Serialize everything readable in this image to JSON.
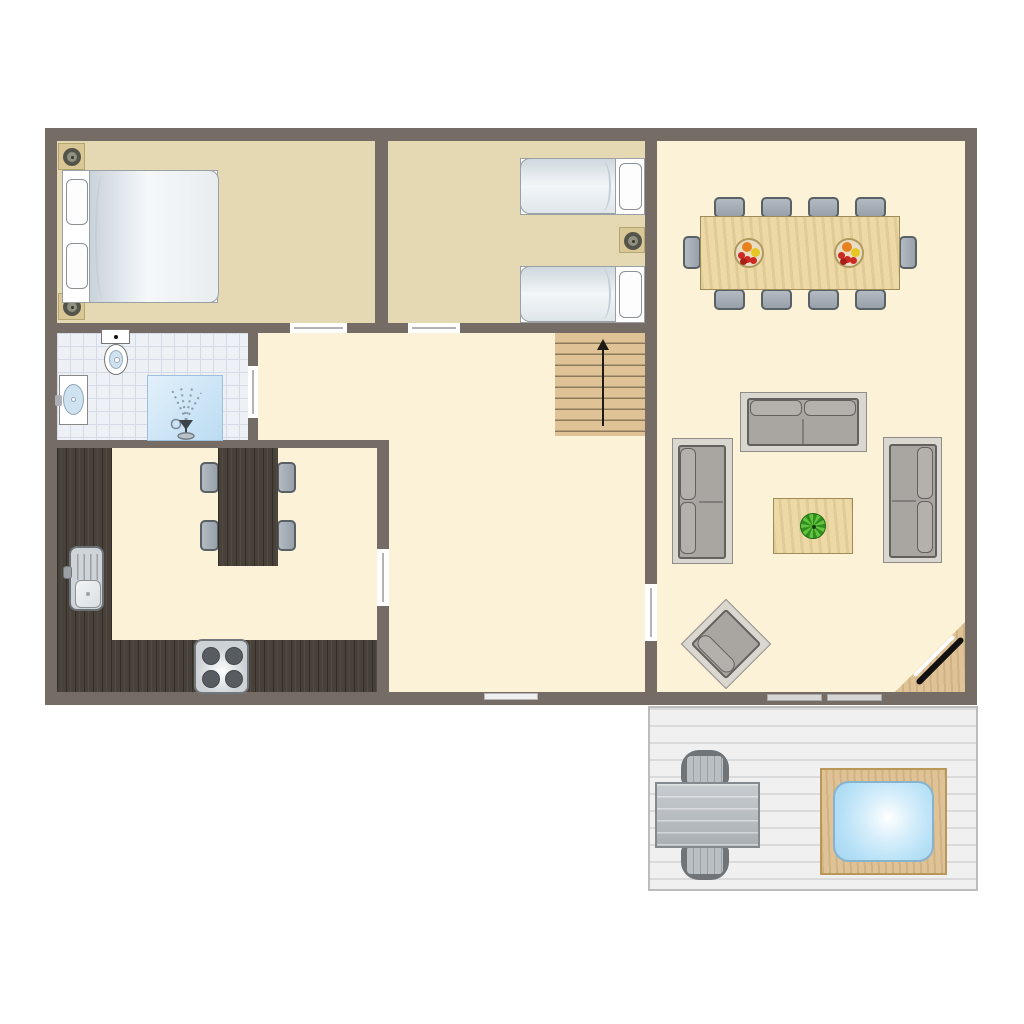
{
  "title": "Holiday home ground floor plan",
  "colors": {
    "wall": "#746c65",
    "floor-cream": "#fbf2d7",
    "floor-tan": "#e4d9b2",
    "tile": "#edf0f5",
    "tile-line": "#d5dbe6",
    "wood-light": "#ecd9a6",
    "wood-mid": "#dfc295",
    "wood-dark": "#474139",
    "deck": "#f0f0f0",
    "deck-line": "#dadada",
    "water": "#b5e0f6",
    "chair-border": "#596066",
    "sofa": "#a9a6a2",
    "sofa-base": "#dad7d1",
    "sofa-border": "#63605d",
    "bed-light": "#f5f8fa",
    "bed-shade": "#c9d3da",
    "fixture-border": "#8b9196",
    "basin-blue": "#cfe2f0",
    "door-line": "#b3b3b3",
    "plant-dark": "#2f8f1f",
    "plant-light": "#64c23c",
    "bowl": "#e9ddc3",
    "fruit-red": "#cc2a22",
    "fruit-orange": "#e8821e",
    "fruit-yellow": "#e8c622",
    "spot-square": "#d9c795",
    "arrow": "#1e1a14"
  },
  "plan": {
    "rooms": [
      {
        "name": "bedroom-double",
        "furniture": [
          "double-bed",
          "two-pillows",
          "spotlight",
          "spotlight"
        ],
        "door_to": "hallway"
      },
      {
        "name": "bedroom-twin",
        "furniture": [
          "single-bed",
          "single-bed",
          "spotlight"
        ],
        "door_to": "hallway"
      },
      {
        "name": "bathroom",
        "furniture": [
          "toilet",
          "washbasin",
          "shower"
        ],
        "door_to": "hallway"
      },
      {
        "name": "kitchen",
        "furniture": [
          "l-shaped-counter",
          "sink",
          "stove-4-burners",
          "kitchen-table",
          "kitchen-chairs-x4"
        ],
        "door_to": "hallway"
      },
      {
        "name": "hallway",
        "furniture": [
          "staircase-up"
        ],
        "windows": 1
      },
      {
        "name": "living-dining-room",
        "furniture": [
          "dining-table",
          "dining-chairs-x10",
          "fruit-bowl",
          "fruit-bowl",
          "sofa-top",
          "sofa-left",
          "sofa-right",
          "coffee-table",
          "potted-plant",
          "lounge-chair-diagonal",
          "corner-tv-unit"
        ],
        "door_to": "terrace"
      },
      {
        "name": "terrace",
        "furniture": [
          "outdoor-table",
          "outdoor-chairs-x2",
          "hot-tub"
        ]
      }
    ],
    "counts": {
      "dining_chairs": 10,
      "kitchen_chairs": 4,
      "terrace_chairs": 2,
      "sofas": 3,
      "beds": 3,
      "spotlights": 3,
      "stair_treads": 9
    }
  }
}
